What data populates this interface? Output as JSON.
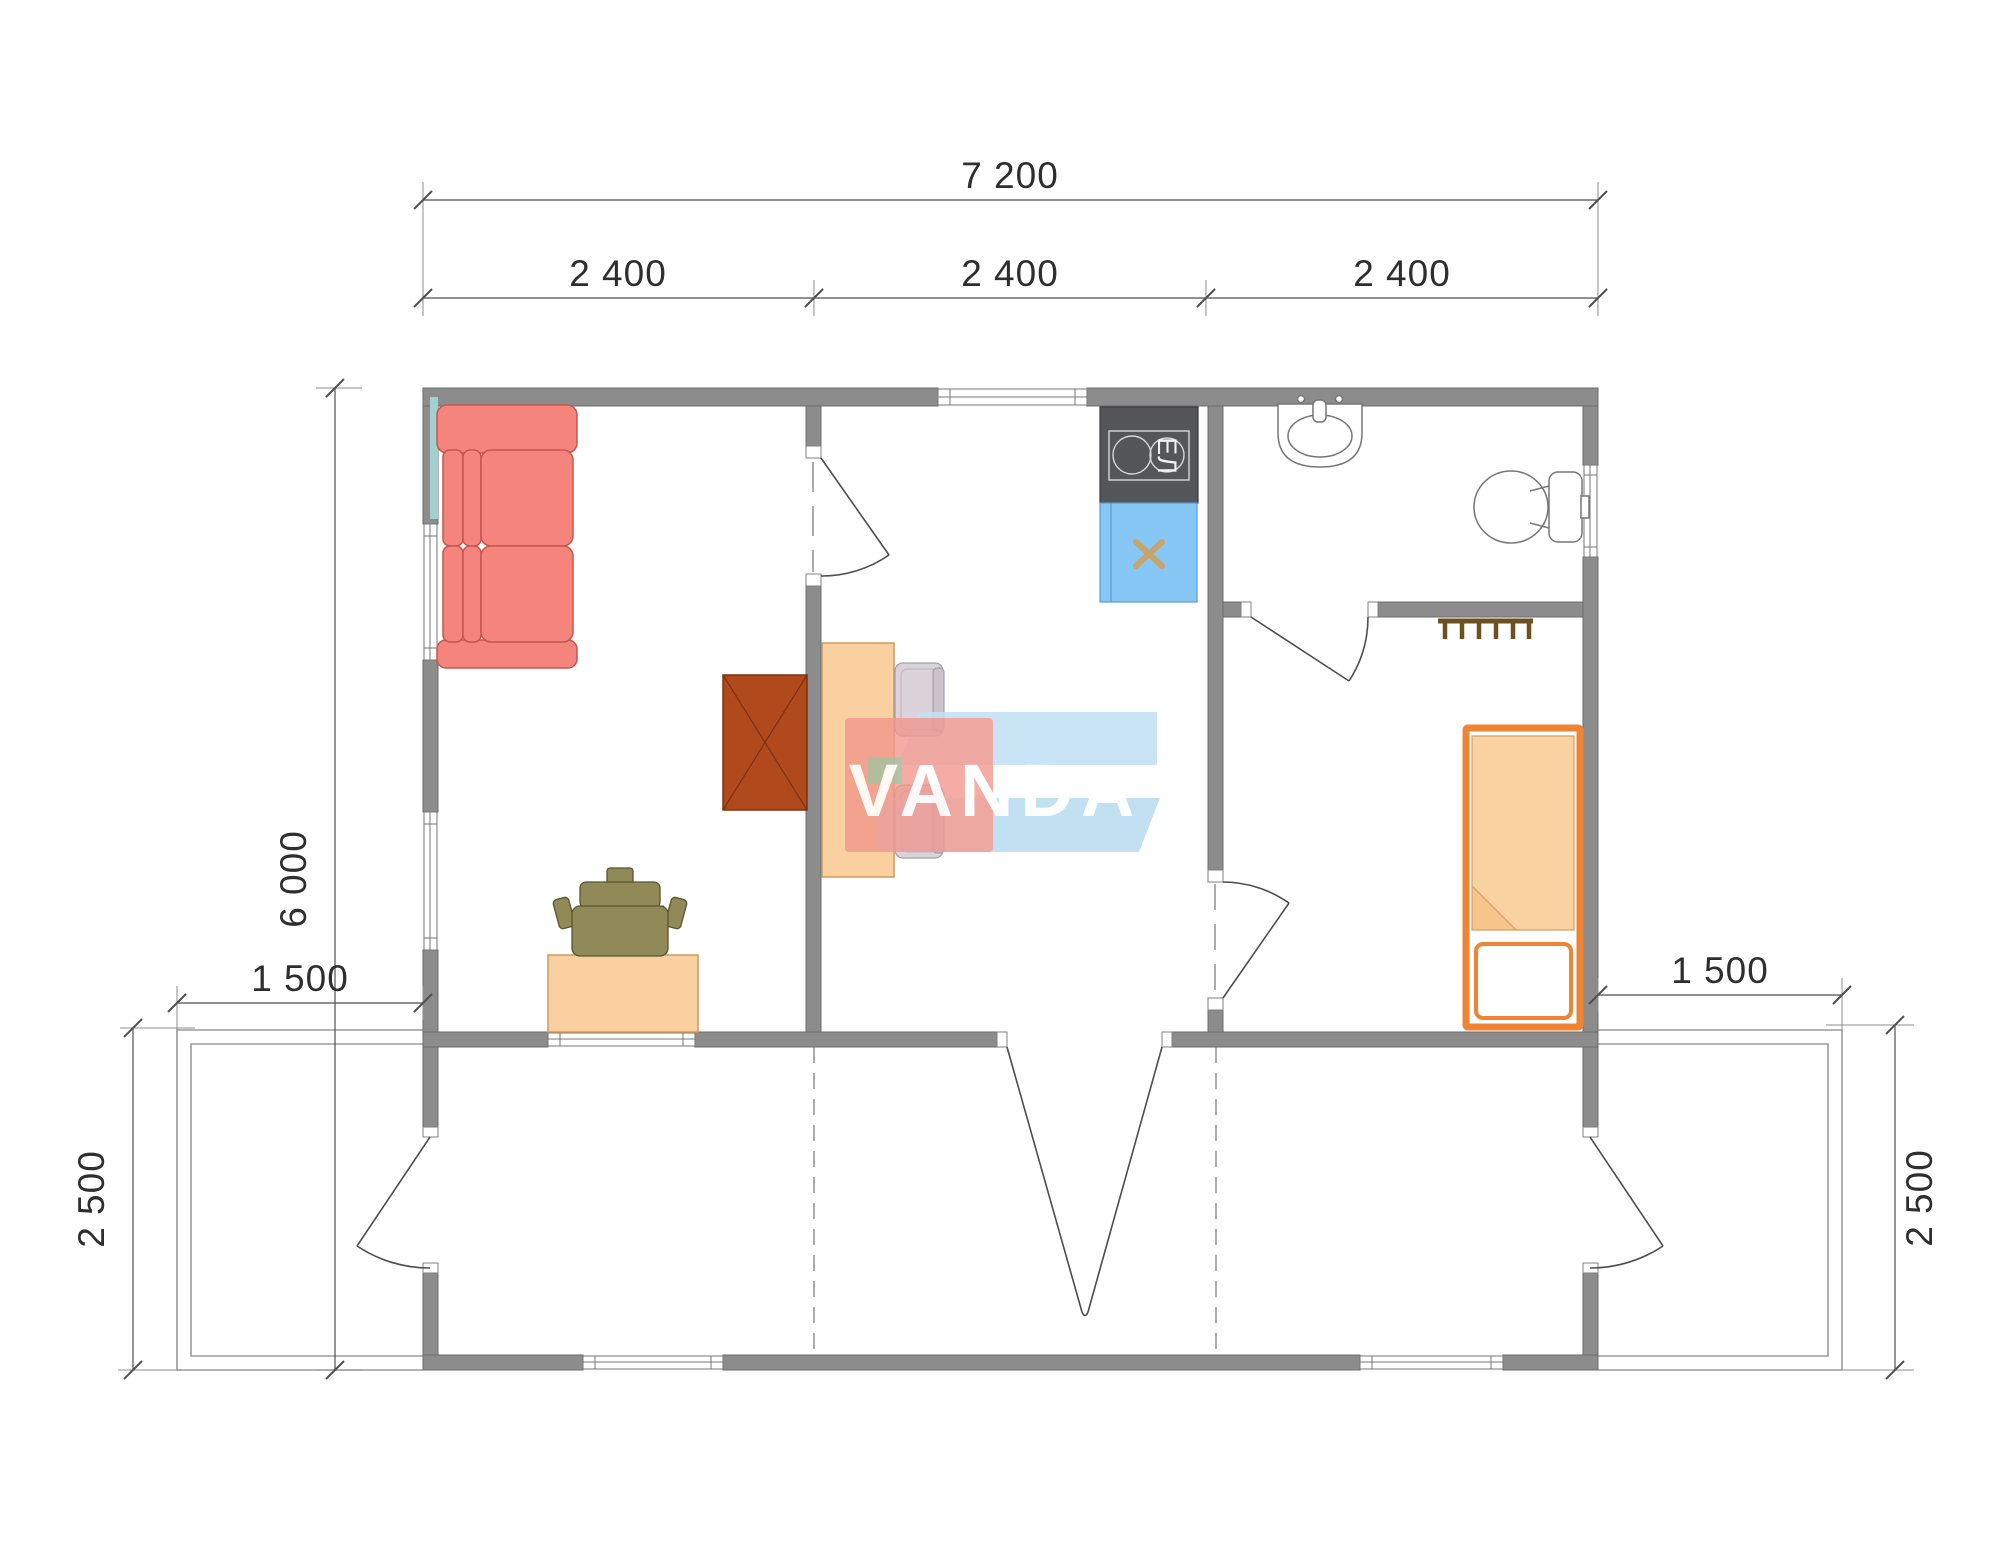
{
  "drawing": {
    "type": "architectural-floor-plan",
    "watermark_text": "VANDA",
    "stove_label": "ЕЛ"
  },
  "dimensions": {
    "top_total": "7 200",
    "top_modules": [
      "2 400",
      "2 400",
      "2 400"
    ],
    "side_total": "6 000",
    "left_deck_width": "1 500",
    "right_deck_width": "1 500",
    "left_deck_depth": "2 500",
    "right_deck_depth": "2 500"
  },
  "furniture": [
    "corner-sofa",
    "wardrobe",
    "dining-table",
    "chair",
    "chair",
    "desk",
    "office-chair",
    "electric-stove",
    "kitchen-sink",
    "washbasin",
    "toilet",
    "single-bed",
    "coat-rack"
  ],
  "colors": {
    "wall": "#8C8C8C",
    "sofa": "#F5857C",
    "wardrobe": "#B0491C",
    "table": "#FBD0A0",
    "bed_frame": "#EE8434",
    "blanket": "#FAD2A2",
    "kitchen_sink": "#87C7F6",
    "stove": "#55565A",
    "office_chair": "#8F8A58",
    "logo_blue": "#BCE0F4",
    "logo_red": "#F2968C"
  }
}
